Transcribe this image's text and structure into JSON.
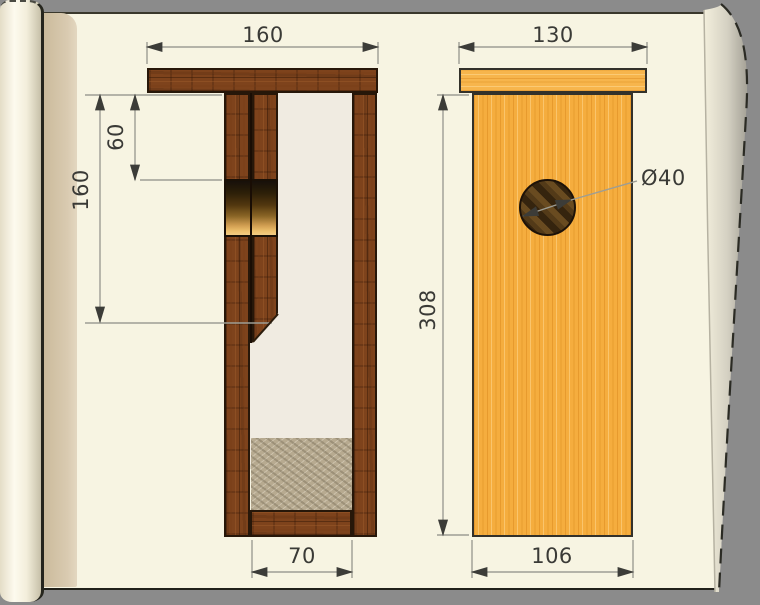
{
  "drawing": {
    "type": "nest-box woodworking plan",
    "left_view": {
      "name": "side cross-section",
      "dims": {
        "overall_width": "160",
        "entrance_offset": "60",
        "front_board_length": "160",
        "inner_floor_width": "70"
      }
    },
    "right_view": {
      "name": "front elevation",
      "dims": {
        "roof_width": "130",
        "body_height": "308",
        "front_panel_width": "106",
        "entrance_hole_diameter": "Ø40"
      }
    },
    "colors": {
      "paper": "#f7f4e2",
      "backdrop": "#8b8b8b",
      "dark_wood": "#7e431c",
      "light_wood": "#f5ad3e",
      "sand_fill": "#b7aa90",
      "dimension_text": "#3a3a36",
      "dimension_line": "#9d9d94"
    }
  }
}
